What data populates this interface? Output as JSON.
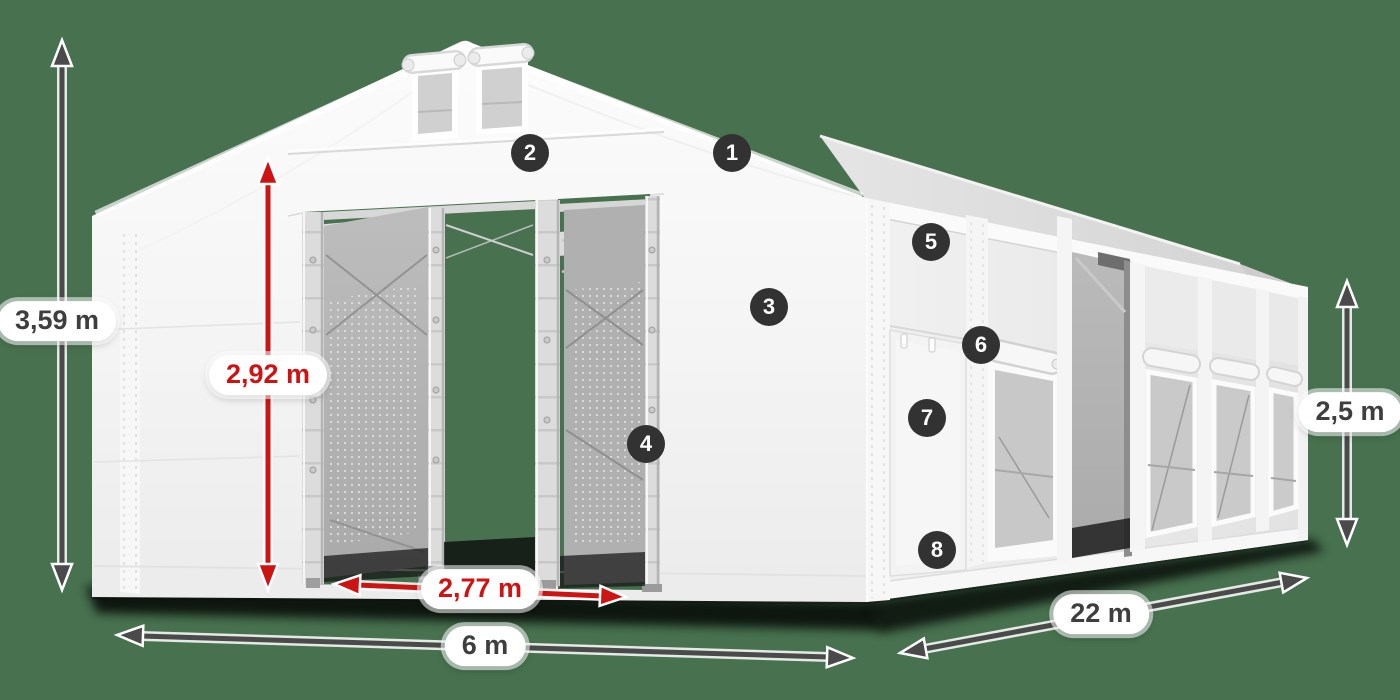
{
  "colors": {
    "background": "#47714F",
    "dimension_dark": "#4A4A4A",
    "dimension_red": "#CE1313",
    "marker_background": "#323232",
    "tent_white": "#F5F5F5"
  },
  "dimensions": {
    "total_height": {
      "label": "3,59 m"
    },
    "entrance_height": {
      "label": "2,92 m"
    },
    "entrance_width": {
      "label": "2,77 m"
    },
    "width": {
      "label": "6 m"
    },
    "length": {
      "label": "22 m"
    },
    "side_height": {
      "label": "2,5 m"
    }
  },
  "markers": [
    {
      "number": "1"
    },
    {
      "number": "2"
    },
    {
      "number": "3"
    },
    {
      "number": "4"
    },
    {
      "number": "5"
    },
    {
      "number": "6"
    },
    {
      "number": "7"
    },
    {
      "number": "8"
    }
  ]
}
